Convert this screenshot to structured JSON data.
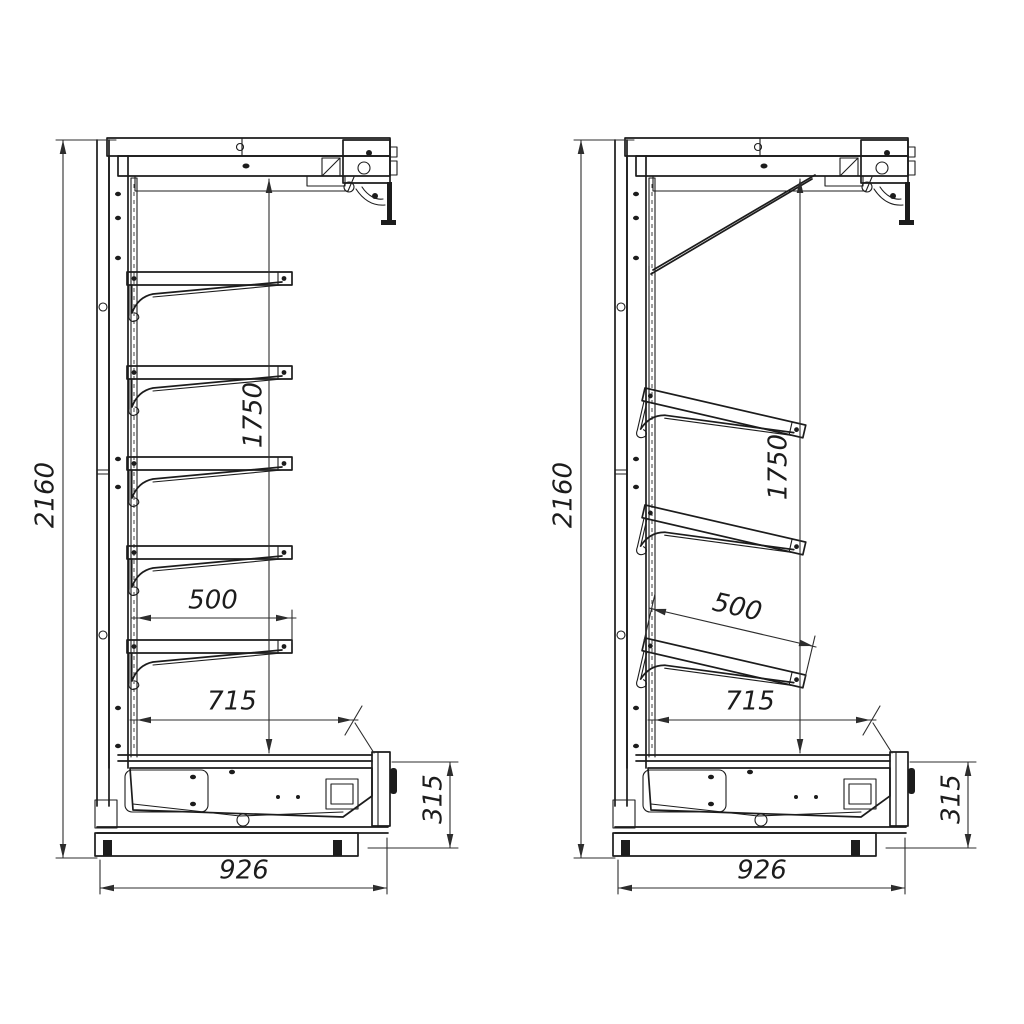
{
  "page": {
    "background_color": "#ffffff",
    "line_color": "#1c1c1c",
    "dimension_color": "#2d2d2d",
    "text_color": "#1c1c1c"
  },
  "drawings": [
    {
      "name": "side-view-straight-shelves",
      "shelves_visible": 5,
      "dims": {
        "height": "2160",
        "inner_height": "1750",
        "shelf_depth": "500",
        "deck_depth": "715",
        "base_height": "315",
        "overall_depth": "926"
      }
    },
    {
      "name": "side-view-inclined-shelves",
      "shelves_visible": 3,
      "dims": {
        "height": "2160",
        "inner_height": "1750",
        "shelf_depth": "500",
        "deck_depth": "715",
        "base_height": "315",
        "overall_depth": "926"
      }
    }
  ]
}
